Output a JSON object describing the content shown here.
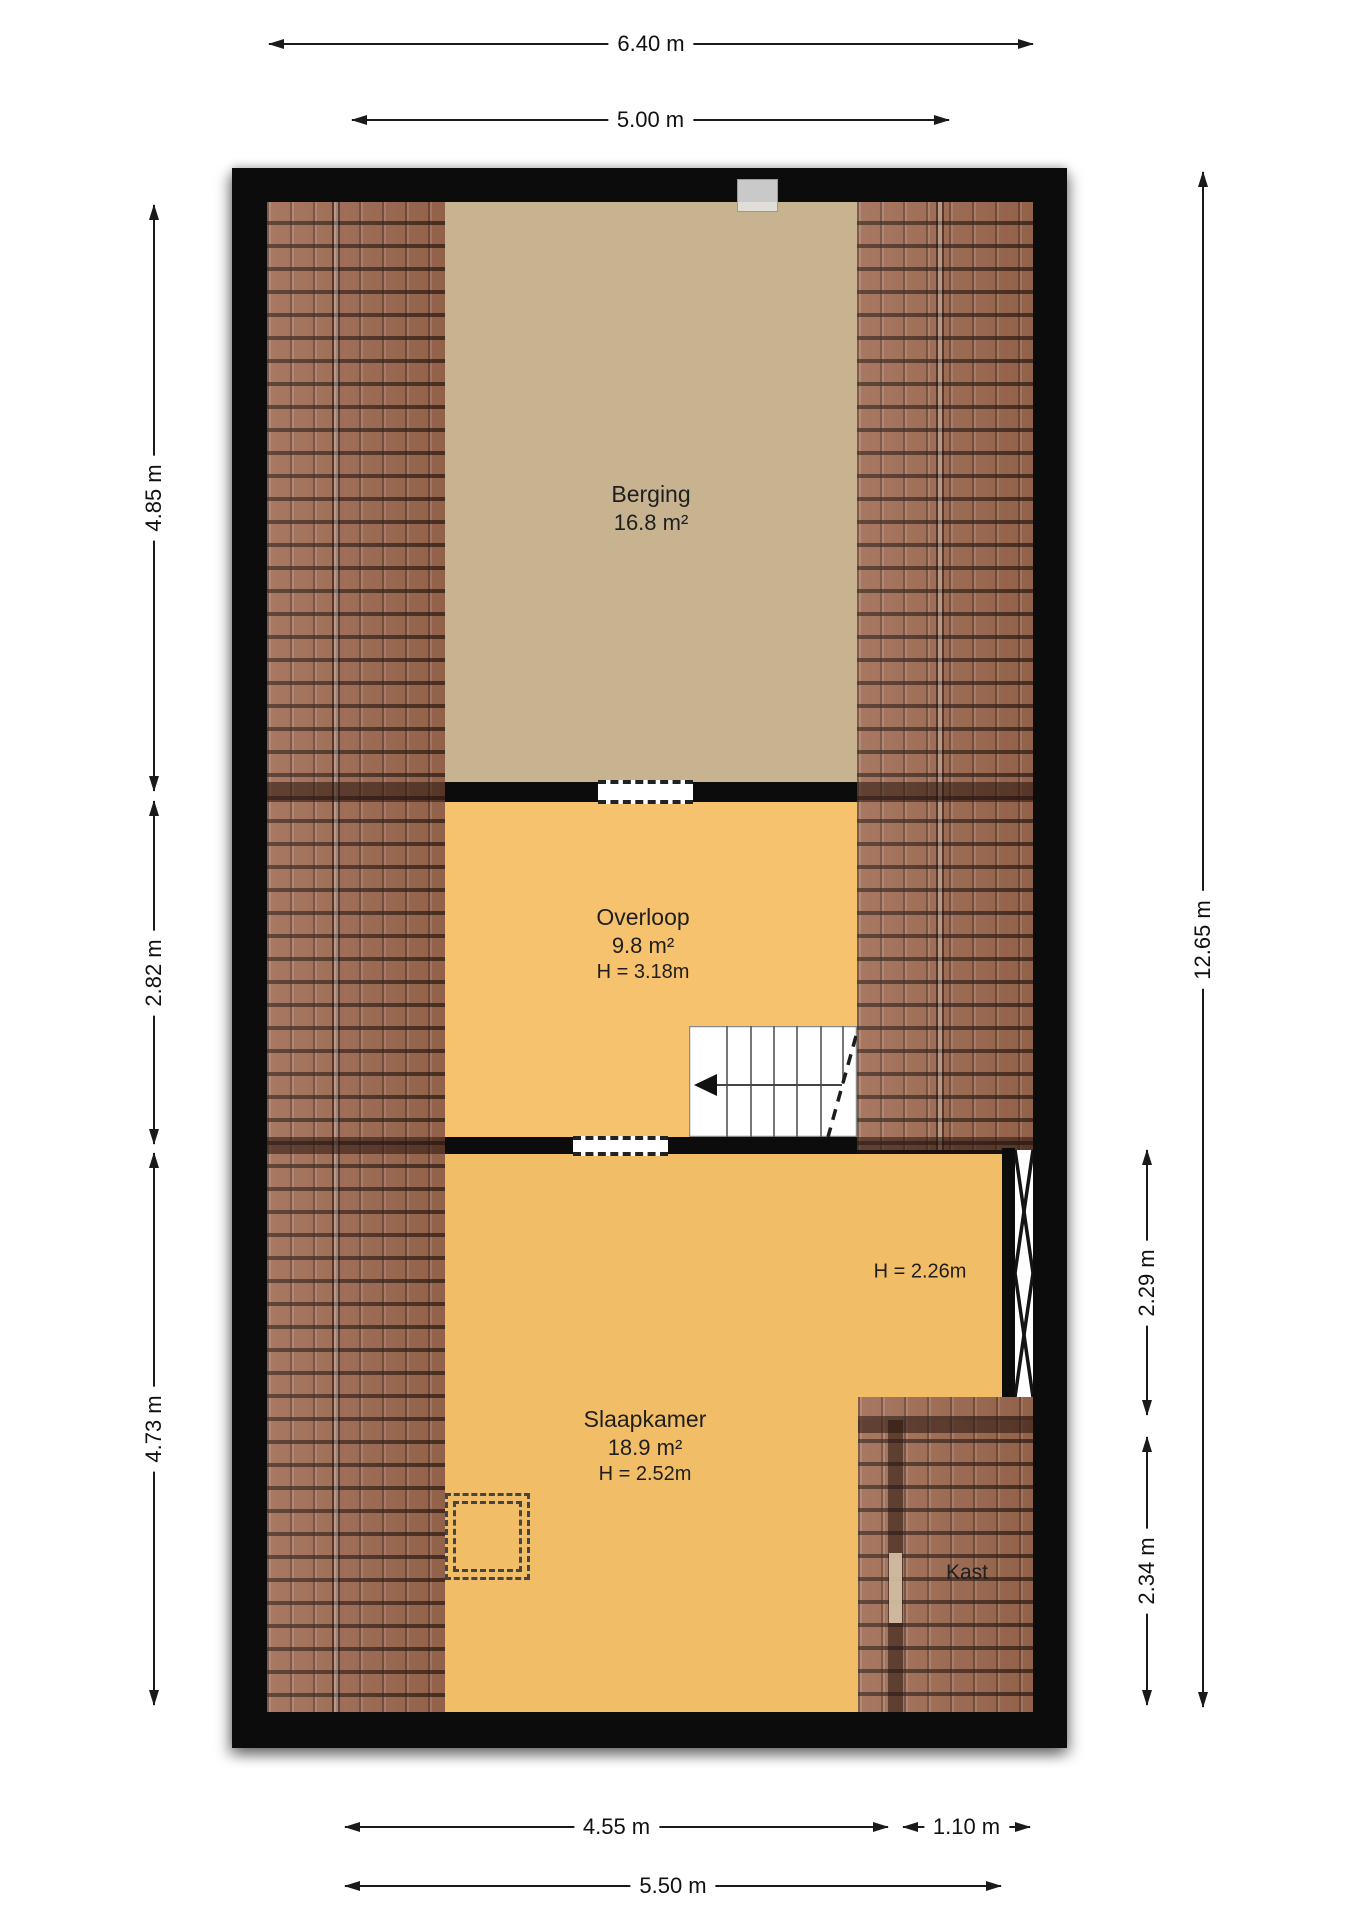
{
  "rooms": [
    {
      "id": "berging",
      "name": "Berging",
      "area": "16.8 m²"
    },
    {
      "id": "overloop",
      "name": "Overloop",
      "area": "9.8 m²",
      "ceiling": "H = 3.18m"
    },
    {
      "id": "slaapkamer",
      "name": "Slaapkamer",
      "area": "18.9 m²",
      "ceiling": "H = 2.52m",
      "low_ceiling_note": "H = 2.26m"
    },
    {
      "id": "kast",
      "name": "Kast"
    }
  ],
  "dimensions": {
    "top": [
      {
        "label": "6.40 m"
      },
      {
        "label": "5.00 m"
      }
    ],
    "left": [
      {
        "label": "4.85 m"
      },
      {
        "label": "2.82 m"
      },
      {
        "label": "4.73 m"
      }
    ],
    "right": [
      {
        "label": "12.65 m"
      },
      {
        "label": "2.29 m"
      },
      {
        "label": "2.34 m"
      }
    ],
    "bottom": [
      {
        "label": "4.55 m"
      },
      {
        "label": "1.10 m"
      },
      {
        "label": "5.50 m"
      }
    ]
  },
  "colors": {
    "wall": "#0c0c0c",
    "roof_tile": "#9e6950",
    "berging_floor": "#c8b391",
    "overloop_floor": "#f7c26d",
    "slaapkamer_floor": "#f1bd66",
    "dimension_text": "#111111"
  }
}
